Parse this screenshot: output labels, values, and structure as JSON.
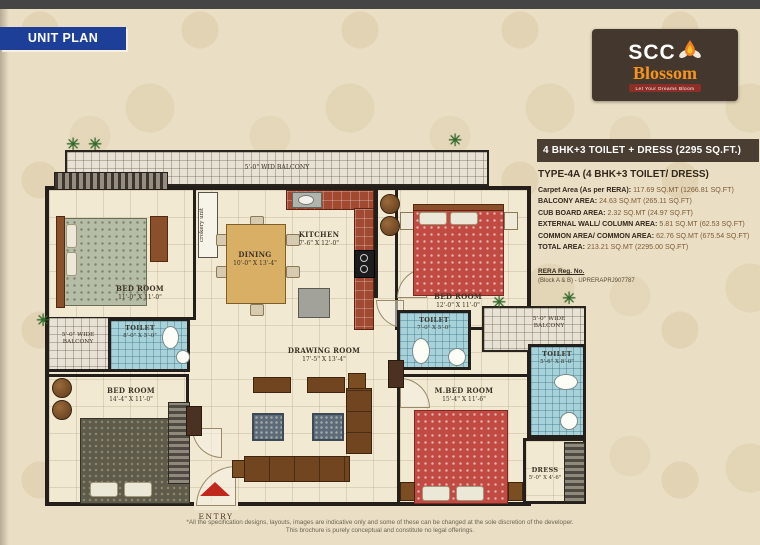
{
  "icons": {
    "plant": "✳"
  },
  "colors": {
    "banner_blue": "#1d3f97",
    "logo_brown": "#44382e",
    "logo_orange": "#f7941d",
    "panel_brown": "#4a3d31",
    "entry_red": "#c0281e"
  },
  "banner": {
    "title": "UNIT PLAN"
  },
  "logo": {
    "name_top": "SCC",
    "name_bottom": "Blossom",
    "tagline": "Let Your Dreams Bloom"
  },
  "unit_info": {
    "header": "4 BHK+3 TOILET + DRESS (2295 SQ.FT.)",
    "type_title": "TYPE-4A (4 BHK+3 TOILET/ DRESS)",
    "areas": [
      {
        "label": "Carpet Area (As per RERA):",
        "value": " 117.69 SQ.MT (1266.81 SQ.FT)"
      },
      {
        "label": "BALCONY AREA:",
        "value": " 24.63 SQ.MT (265.11 SQ.FT)"
      },
      {
        "label": "CUB BOARD AREA:",
        "value": " 2.32 SQ.MT (24.97 SQ.FT)"
      },
      {
        "label": "EXTERNAL WALL/ COLUMN AREA:",
        "value": " 5.81 SQ.MT (62.53 SQ.FT)"
      },
      {
        "label": "COMMON AREA/ COMMON AREA:",
        "value": " 62.76 SQ.MT (675.54 SQ.FT)"
      },
      {
        "label": "TOTAL AREA:",
        "value": " 213.21 SQ.MT (2295.00 SQ.FT)"
      }
    ],
    "rera_heading": "RERA Reg. No.",
    "rera_number": "(Block A & B) - UPRERAPRJ907787"
  },
  "plan": {
    "balcony_top": "5'-0\" WID BALCONY",
    "balcony_left": {
      "line1": "5'-0\" WIDE",
      "line2": "BALCONY"
    },
    "balcony_right": {
      "line1": "5'-0\" WIDE",
      "line2": "BALCONY"
    },
    "crockery": "crokery unit",
    "entry": "ENTRY",
    "rooms": {
      "bed1": {
        "name": "BED ROOM",
        "dims": "11'-0\" X 11'-0\""
      },
      "dining": {
        "name": "DINING",
        "dims": "10'-0\" X 13'-4\""
      },
      "kitchen": {
        "name": "KITCHEN",
        "dims": "7'-6\" X 12'-0\""
      },
      "bed2": {
        "name": "BED ROOM",
        "dims": "12'-0\" X 11'-0\""
      },
      "toilet_left": {
        "name": "TOILET",
        "dims": "8'-0\" X 5'-0\""
      },
      "toilet_mid": {
        "name": "TOILET",
        "dims": "7'-0\" X 5'-0\""
      },
      "drawing": {
        "name": "DRAWING ROOM",
        "dims": "17'-5\" X 13'-4\""
      },
      "bed3": {
        "name": "BED ROOM",
        "dims": "14'-4\" X 11'-0\""
      },
      "mbed": {
        "name": "M.BED ROOM",
        "dims": "15'-4\" X 11'-6\""
      },
      "toilet_right": {
        "name": "TOILET",
        "dims": "5'-6\" X 8'-0\""
      },
      "dress": {
        "name": "DRESS",
        "dims": "5'-0\" X 4'-6\""
      }
    }
  },
  "disclaimer": {
    "line1": "*All the specification designs, layouts, images are indicative only and some of these can be changed at the sole discretion of the developer.",
    "line2": "This brochure is purely conceptual and constitute no legal offerings."
  }
}
